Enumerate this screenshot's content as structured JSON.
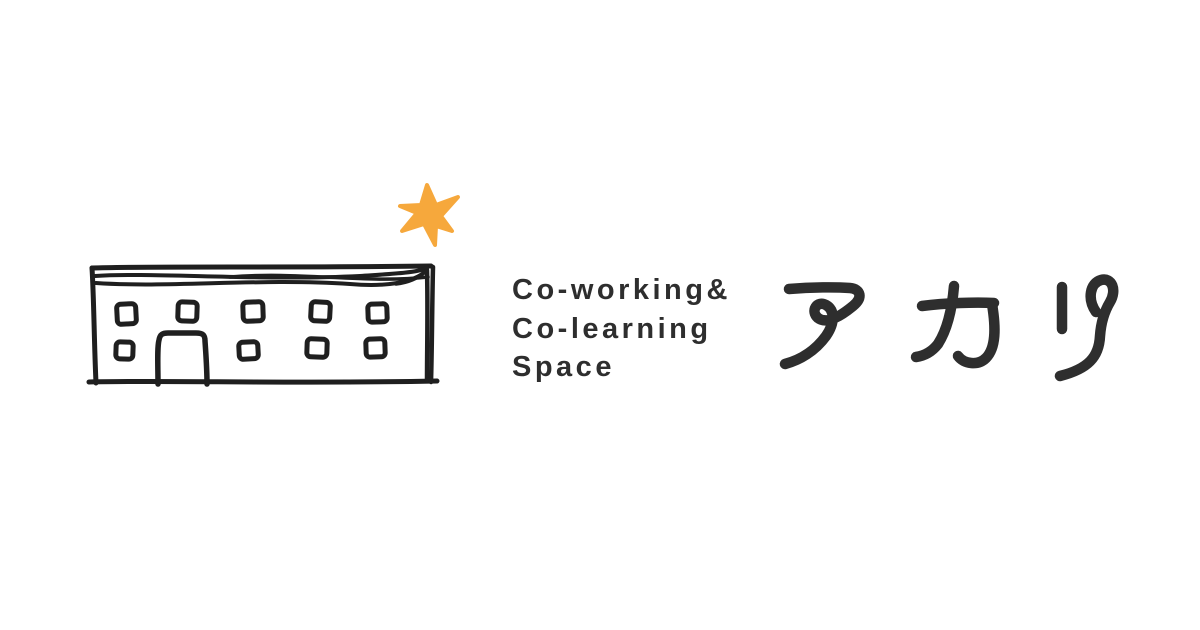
{
  "canvas": {
    "width": 1200,
    "height": 630
  },
  "colors": {
    "bg": "#FFFFFF",
    "ink": "#1F1F1F",
    "text": "#2E2E2E",
    "star": "#F6A83C"
  },
  "logo": {
    "tagline_lines": [
      "Co-working&",
      "Co-learning",
      "Space"
    ],
    "brand_name": "アカリ"
  }
}
